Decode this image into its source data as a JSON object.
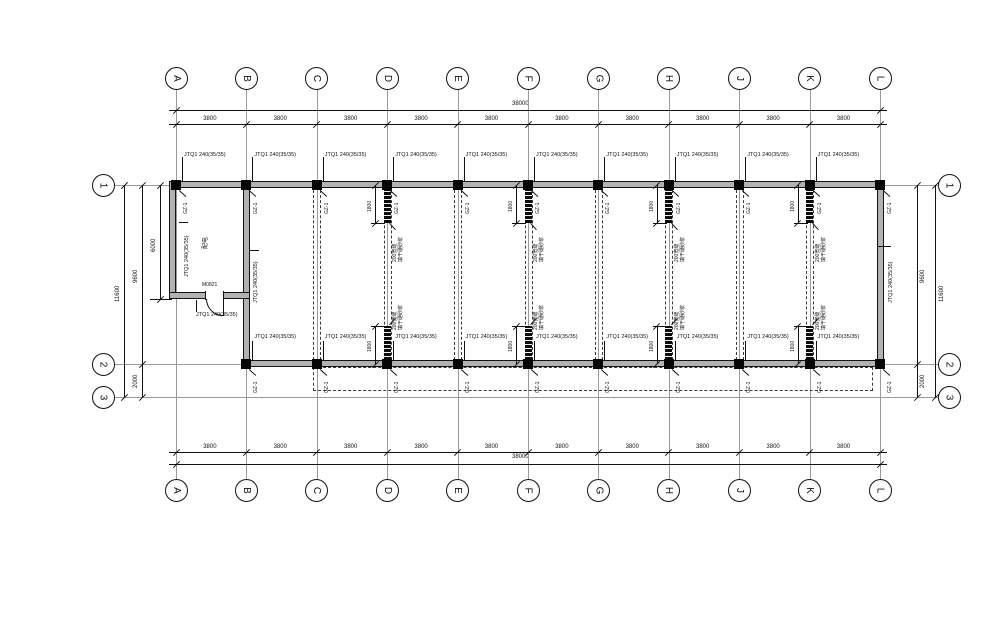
{
  "grid": {
    "letters": [
      "A",
      "B",
      "C",
      "D",
      "E",
      "F",
      "G",
      "H",
      "J",
      "K",
      "L"
    ],
    "numbers": [
      "1",
      "2",
      "3"
    ]
  },
  "dims": {
    "bay": "3800",
    "total": "38000",
    "depth_total": "11600",
    "depth_main": "9600",
    "depth_lower": "2000",
    "room_depth": "6000",
    "joint": "1800"
  },
  "labels": {
    "wall_type": "JTQ1 240(35/35)",
    "column_tag": "GZ-1",
    "door": "M0821",
    "room": "配电",
    "joint_note": [
      "200宽缝",
      "填干硬砂浆"
    ]
  },
  "colors": {
    "ink": "#111111",
    "wall_fill": "#b2b2b2",
    "grid_line": "#9a9a9a"
  }
}
